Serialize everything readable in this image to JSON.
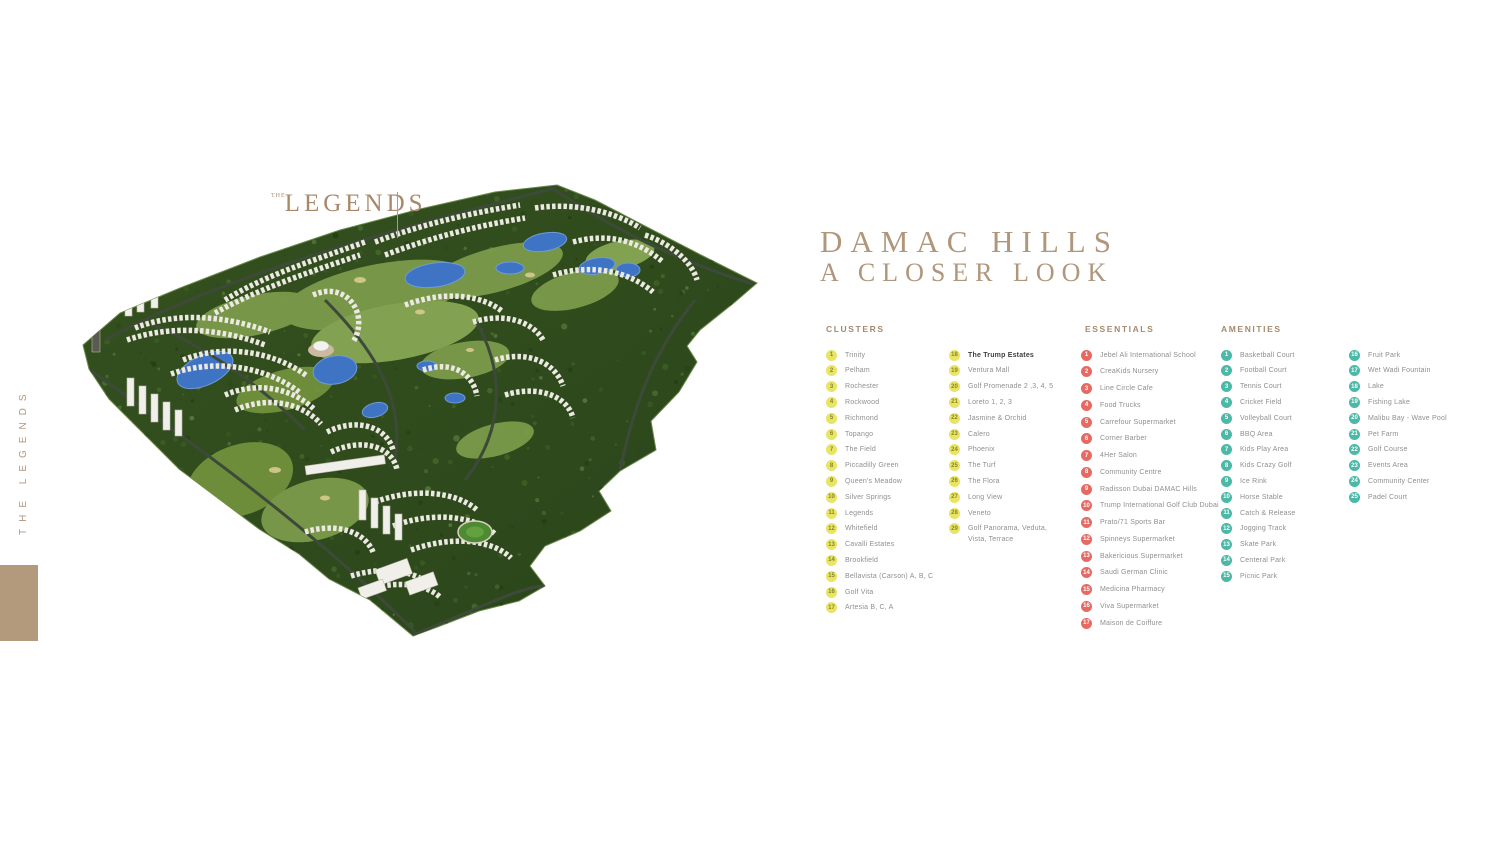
{
  "sidebar": {
    "vertical_label": "THE LEGENDS"
  },
  "map": {
    "logo_top": "THE",
    "logo_main": "LEGENDS",
    "markers": [
      [
        383,
        29,
        "y",
        "9"
      ],
      [
        299,
        57,
        "y",
        "10"
      ],
      [
        263,
        78,
        "r",
        "12"
      ],
      [
        430,
        43,
        "r",
        "13"
      ],
      [
        448,
        71,
        "y",
        "8"
      ],
      [
        348,
        99,
        "t",
        "28"
      ],
      [
        159,
        117,
        "y",
        "12"
      ],
      [
        249,
        127,
        "y",
        "11"
      ],
      [
        65,
        136,
        "y",
        "15"
      ],
      [
        98,
        147,
        "y",
        "14"
      ],
      [
        31,
        151,
        "y",
        "16"
      ],
      [
        323,
        140,
        "t",
        "22"
      ],
      [
        400,
        135,
        "y",
        "7"
      ],
      [
        423,
        145,
        "t",
        "7"
      ],
      [
        207,
        149,
        "t",
        "23"
      ],
      [
        128,
        168,
        "t",
        "23"
      ],
      [
        163,
        165,
        "y",
        "13"
      ],
      [
        261,
        160,
        "y",
        "13"
      ],
      [
        248,
        170,
        "y",
        "10"
      ],
      [
        347,
        163,
        "t",
        "21"
      ],
      [
        352,
        174,
        "t",
        "3"
      ],
      [
        376,
        173,
        "t",
        "18"
      ],
      [
        417,
        169,
        "y",
        "6"
      ],
      [
        329,
        192,
        "t",
        "26"
      ],
      [
        345,
        197,
        "t",
        "27"
      ],
      [
        363,
        197,
        "t",
        "17"
      ],
      [
        389,
        204,
        "t",
        "20"
      ],
      [
        377,
        207,
        "t",
        "11"
      ],
      [
        424,
        211,
        "y",
        "5"
      ],
      [
        65,
        207,
        "y",
        "17"
      ],
      [
        39,
        219,
        "r",
        "14"
      ],
      [
        47,
        230,
        "r",
        "16"
      ],
      [
        55,
        238,
        "r",
        "15"
      ],
      [
        65,
        248,
        "r",
        "17"
      ],
      [
        73,
        246,
        "r",
        "9"
      ],
      [
        135,
        210,
        "y",
        "18"
      ],
      [
        378,
        220,
        "t",
        "6"
      ],
      [
        365,
        228,
        "t",
        "19"
      ],
      [
        384,
        229,
        "t",
        "7"
      ],
      [
        392,
        235,
        "t",
        "1"
      ],
      [
        274,
        224,
        "y",
        "21"
      ],
      [
        307,
        229,
        "t",
        "16"
      ],
      [
        312,
        239,
        "t",
        "23"
      ],
      [
        269,
        248,
        "y",
        "24"
      ],
      [
        224,
        254,
        "t",
        "24"
      ],
      [
        237,
        257,
        "t",
        "25"
      ],
      [
        258,
        262,
        "t",
        "1"
      ],
      [
        276,
        262,
        "t",
        "6"
      ],
      [
        209,
        267,
        "r",
        "7"
      ],
      [
        229,
        268,
        "r",
        "8"
      ],
      [
        251,
        276,
        "t",
        "23"
      ],
      [
        278,
        276,
        "t",
        "9"
      ],
      [
        258,
        284,
        "t",
        "4"
      ],
      [
        218,
        285,
        "r",
        "6"
      ],
      [
        263,
        291,
        "t",
        "5"
      ],
      [
        312,
        282,
        "t",
        "9"
      ],
      [
        325,
        287,
        "t",
        "10"
      ],
      [
        286,
        295,
        "t",
        "18"
      ],
      [
        268,
        299,
        "t",
        "25"
      ],
      [
        247,
        299,
        "y",
        "21"
      ],
      [
        217,
        301,
        "y",
        "29"
      ],
      [
        273,
        305,
        "t",
        "3"
      ],
      [
        374,
        266,
        "y",
        "4"
      ],
      [
        127,
        287,
        "y",
        "19"
      ],
      [
        186,
        321,
        "y",
        "20"
      ],
      [
        345,
        319,
        "y",
        "5"
      ],
      [
        274,
        321,
        "t",
        "8"
      ],
      [
        359,
        339,
        "t",
        "6"
      ],
      [
        299,
        337,
        "t",
        "12"
      ],
      [
        398,
        350,
        "t",
        "2"
      ],
      [
        280,
        347,
        "t",
        "9"
      ],
      [
        367,
        364,
        "y",
        "2"
      ],
      [
        256,
        360,
        "t",
        "13"
      ],
      [
        321,
        365,
        "t",
        "7"
      ],
      [
        241,
        332,
        "r",
        "5"
      ],
      [
        256,
        337,
        "r",
        "6"
      ],
      [
        239,
        357,
        "r",
        "3"
      ],
      [
        209,
        361,
        "y",
        "23"
      ],
      [
        275,
        362,
        "y",
        "22"
      ],
      [
        313,
        372,
        "t",
        "8"
      ],
      [
        276,
        376,
        "t",
        "14"
      ],
      [
        267,
        370,
        "t",
        "15"
      ],
      [
        277,
        387,
        "t",
        "11"
      ],
      [
        293,
        393,
        "y",
        "8"
      ],
      [
        260,
        406,
        "r",
        "2"
      ],
      [
        254,
        424,
        "r",
        "1"
      ]
    ]
  },
  "title": {
    "line1": "DAMAC HILLS",
    "line2": "A CLOSER LOOK"
  },
  "legend": {
    "clusters": {
      "header": "CLUSTERS",
      "marker_type": "y",
      "columns": [
        [
          {
            "n": "1",
            "label": "Trinity"
          },
          {
            "n": "2",
            "label": "Pelham"
          },
          {
            "n": "3",
            "label": "Rochester"
          },
          {
            "n": "4",
            "label": "Rockwood"
          },
          {
            "n": "5",
            "label": "Richmond"
          },
          {
            "n": "6",
            "label": "Topango"
          },
          {
            "n": "7",
            "label": "The Field"
          },
          {
            "n": "8",
            "label": "Piccadilly Green"
          },
          {
            "n": "9",
            "label": "Queen's Meadow"
          },
          {
            "n": "10",
            "label": "Silver Springs"
          },
          {
            "n": "11",
            "label": "Legends"
          },
          {
            "n": "12",
            "label": "Whitefield"
          },
          {
            "n": "13",
            "label": "Cavalli Estates"
          },
          {
            "n": "14",
            "label": "Brookfield"
          },
          {
            "n": "15",
            "label": "Bellavista (Carson) A, B, C"
          },
          {
            "n": "16",
            "label": "Golf Vita"
          },
          {
            "n": "17",
            "label": "Artesia B, C, A"
          }
        ],
        [
          {
            "n": "18",
            "label": "The Trump Estates",
            "bold": true
          },
          {
            "n": "19",
            "label": "Ventura Mall"
          },
          {
            "n": "20",
            "label": "Golf Promenade 2 ,3, 4, 5"
          },
          {
            "n": "21",
            "label": "Loreto 1, 2, 3"
          },
          {
            "n": "22",
            "label": "Jasmine & Orchid"
          },
          {
            "n": "23",
            "label": "Calero"
          },
          {
            "n": "24",
            "label": "Phoenix"
          },
          {
            "n": "25",
            "label": "The Turf"
          },
          {
            "n": "26",
            "label": "The Flora"
          },
          {
            "n": "27",
            "label": "Long View"
          },
          {
            "n": "28",
            "label": "Veneto"
          },
          {
            "n": "29",
            "label": "Golf Panorama, Veduta,",
            "label2": "Vista, Terrace"
          }
        ]
      ]
    },
    "essentials": {
      "header": "ESSENTIALS",
      "marker_type": "r",
      "columns": [
        [
          {
            "n": "1",
            "label": "Jebel Ali International School"
          },
          {
            "n": "2",
            "label": "CreaKids Nursery"
          },
          {
            "n": "3",
            "label": "Line Circle Cafe"
          },
          {
            "n": "4",
            "label": "Food Trucks"
          },
          {
            "n": "5",
            "label": "Carrefour Supermarket"
          },
          {
            "n": "6",
            "label": "Corner Barber"
          },
          {
            "n": "7",
            "label": "4Her Salon"
          },
          {
            "n": "8",
            "label": "Community Centre"
          },
          {
            "n": "9",
            "label": "Radisson Dubai DAMAC Hills"
          },
          {
            "n": "10",
            "label": "Trump International Golf Club Dubai"
          },
          {
            "n": "11",
            "label": "Prato/71 Sports Bar"
          },
          {
            "n": "12",
            "label": "Spinneys Supermarket"
          },
          {
            "n": "13",
            "label": "Bakericious Supermarket"
          },
          {
            "n": "14",
            "label": "Saudi German Clinic"
          },
          {
            "n": "15",
            "label": "Medicina Pharmacy"
          },
          {
            "n": "16",
            "label": "Viva Supermarket"
          },
          {
            "n": "17",
            "label": "Maison de Coiffure"
          }
        ]
      ]
    },
    "amenities": {
      "header": "AMENITIES",
      "marker_type": "t",
      "columns": [
        [
          {
            "n": "1",
            "label": "Basketball Court"
          },
          {
            "n": "2",
            "label": "Football Court"
          },
          {
            "n": "3",
            "label": "Tennis Court"
          },
          {
            "n": "4",
            "label": "Cricket Field"
          },
          {
            "n": "5",
            "label": "Volleyball Court"
          },
          {
            "n": "6",
            "label": "BBQ Area"
          },
          {
            "n": "7",
            "label": "Kids Play Area"
          },
          {
            "n": "8",
            "label": "Kids Crazy Golf"
          },
          {
            "n": "9",
            "label": "Ice Rink"
          },
          {
            "n": "10",
            "label": "Horse Stable"
          },
          {
            "n": "11",
            "label": "Catch & Release"
          },
          {
            "n": "12",
            "label": "Jogging Track"
          },
          {
            "n": "13",
            "label": "Skate Park"
          },
          {
            "n": "14",
            "label": "Centeral Park"
          },
          {
            "n": "15",
            "label": "Picnic Park"
          }
        ],
        [
          {
            "n": "16",
            "label": "Fruit Park"
          },
          {
            "n": "17",
            "label": "Wet Wadi Fountain"
          },
          {
            "n": "18",
            "label": "Lake"
          },
          {
            "n": "19",
            "label": "Fishing Lake"
          },
          {
            "n": "20",
            "label": "Malibu Bay - Wave Pool"
          },
          {
            "n": "21",
            "label": "Pet Farm"
          },
          {
            "n": "22",
            "label": "Golf Course"
          },
          {
            "n": "23",
            "label": "Events Area"
          },
          {
            "n": "24",
            "label": "Community Center"
          },
          {
            "n": "25",
            "label": "Padel Court"
          }
        ]
      ]
    }
  },
  "colors": {
    "accent_tan": "#b0967b",
    "marker_yellow": "#e9e463",
    "marker_red": "#e66a64",
    "marker_teal": "#4cb8a6",
    "land_green": "#2f4d20",
    "fairway_green": "#7e9d4c",
    "lake_blue": "#3f74c4"
  }
}
